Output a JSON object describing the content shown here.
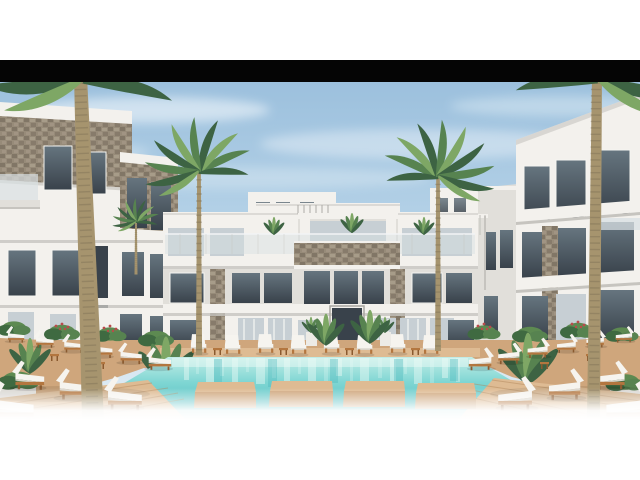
{
  "meta": {
    "title": "Architectural rendering — resort courtyard with swimming pool",
    "description": "3D exterior render of a white modern apartment/resort complex surrounding a turquoise pool with wooden deck walkways, white sun loungers and palm trees. The render is letterboxed: white page margins top and bottom and a solid black bar across the top edge of the photo."
  },
  "colors": {
    "page_bg": "#ffffff",
    "letterbox": "#050505",
    "sky_top": "#9cc0dd",
    "sky_mid": "#bcd7ea",
    "sky_bottom": "#e4eff6",
    "cloud": "#f7fbfd",
    "wall_light": "#f3f1ed",
    "wall_mid": "#e1dfda",
    "wall_shade": "#c6c4bf",
    "wall_dark": "#a8a6a0",
    "stone_base": "#978b79",
    "stone_dark": "#6f6455",
    "stone_light": "#b3a794",
    "glass_dark": "#39424b",
    "glass_mid": "#66757f",
    "glass_pale": "#c7cfd4",
    "rail_glass": "#d8dfe3",
    "palm_green_dark": "#3d6343",
    "palm_green": "#578350",
    "palm_green_light": "#7ea765",
    "trunk": "#a6946e",
    "trunk_dark": "#7f7156",
    "pool_deep": "#45b5bb",
    "pool_mid": "#7fd6d3",
    "pool_light": "#c2ede7",
    "pool_foam": "#eafaf6",
    "deck": "#cfa67c",
    "deck_light": "#debb93",
    "deck_dark": "#ad8257",
    "wood": "#b3763f",
    "wood_dark": "#8a5a2f",
    "cushion": "#f6f4ef",
    "cushion_shade": "#d9d6cd",
    "shrub": "#5d8a51",
    "shrub_dark": "#3f6a41",
    "flower_red": "#b94b4b",
    "planter": "#edebe6"
  },
  "scene": {
    "setting": "resort courtyard, daytime, clear sky",
    "elements": [
      {
        "name": "sky",
        "label": "clear blue sky with thin wispy clouds"
      },
      {
        "name": "letterbox-bar",
        "label": "solid black horizontal bar across top of photo"
      },
      {
        "name": "center-building",
        "label": "three-storey white building with glass balconies, stone accent piers and central dark glazed entrance"
      },
      {
        "name": "left-building",
        "label": "left wing with stone-clad upper band and dark windows"
      },
      {
        "name": "right-building",
        "label": "right wing with balconies and stone pier"
      },
      {
        "name": "background-buildings",
        "label": "low white buildings behind the courtyard"
      },
      {
        "name": "pergola-awning",
        "label": "slatted sun awning on right terrace"
      },
      {
        "name": "palm-trees",
        "label": "tall palms at left and right edges, two palms framing the center building, small background palms"
      },
      {
        "name": "swimming-pool",
        "label": "turquoise pool with vertical light reflections"
      },
      {
        "name": "stepping-platforms",
        "label": "four wooden platforms across the near edge of the pool"
      },
      {
        "name": "walkways",
        "label": "wooden deck walkways at the bottom corners"
      },
      {
        "name": "sun-loungers",
        "label": "white cushioned loungers on wooden frames, grouped left, right and along the far pool edge"
      },
      {
        "name": "side-tables",
        "label": "small wooden side tables between loungers"
      },
      {
        "name": "plants",
        "label": "tropical shrubs and tall leafy plants, some with red flowers"
      },
      {
        "name": "planters",
        "label": "white planter boxes and pots"
      },
      {
        "name": "bottom-fade",
        "label": "photo fades to white at its bottom edge"
      }
    ]
  }
}
